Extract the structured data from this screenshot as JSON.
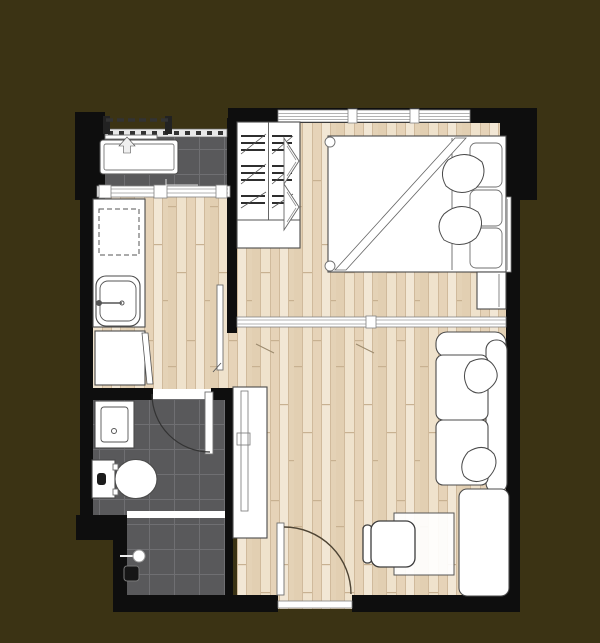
{
  "header": {
    "unit_name": "A2",
    "unit_area": "28.5 sq.m."
  },
  "colors": {
    "bg": "#3b3314",
    "title": "#f2ebc0",
    "wall": "#0e0e0e",
    "wood-base": "#e9d8c0",
    "tile": "#59595b",
    "tile-grout": "#6f6f72",
    "fixture-line": "#4b4b4b",
    "door-arc": "#4e4434",
    "window-line": "#9a9a9a"
  },
  "floorplan": {
    "fixtures": [
      "balcony",
      "laundry-counter",
      "kitchen-counter",
      "kitchen-sink",
      "refrigerator",
      "wardrobe",
      "bed",
      "nightstand",
      "sliding-partition",
      "sofa",
      "side-cabinet",
      "tv-console",
      "desk",
      "chair",
      "entrance-door",
      "bathroom",
      "washbasin",
      "toilet",
      "bathroom-door",
      "shower",
      "shower-partition"
    ]
  }
}
